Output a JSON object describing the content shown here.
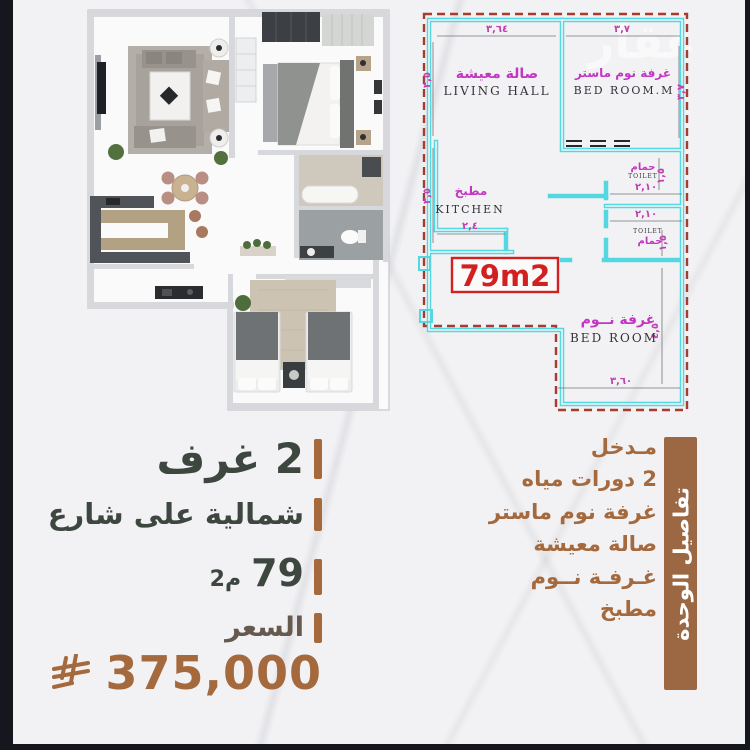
{
  "plan2d": {
    "area_box": "79m2",
    "watermark": "عقار",
    "rooms": {
      "living": {
        "ar": "صالة معيشة",
        "en": "LIVING HALL"
      },
      "master": {
        "ar": "غرفة نوم ماستر",
        "en": "BED ROOM.M"
      },
      "kitchen": {
        "ar": "مطبخ",
        "en": "KITCHEN"
      },
      "toilet1": {
        "ar": "حمام",
        "en": "TOILET"
      },
      "toilet2": {
        "ar": "حمام",
        "en": "TOILET"
      },
      "bedroom": {
        "ar": "غرفة نــوم",
        "en": "BED ROOM"
      }
    },
    "dims": {
      "living_top": "٣,٦٤",
      "master_top": "٣,٧",
      "living_left": "٣,٥",
      "kitchen_left": "٣,٥",
      "master_right": "٣,٧",
      "kitchen_bottom": "٢,٤",
      "toilet1_width": "٢,١٠",
      "toilet2_width": "٢,١٠",
      "toilet1_height": "١,٥",
      "toilet2_height": "١,٥",
      "bedroom_bottom": "٣,٦٠",
      "bedroom_right": "٤,٥"
    }
  },
  "specs": {
    "rooms_count": "2 غرف",
    "orientation": "شمالية على شارع",
    "area_value": "79",
    "area_unit": "م2",
    "price_label": "السعر",
    "price_value": "375,000",
    "currency_icon": "saudi-riyal-symbol"
  },
  "unit_details": {
    "banner": "تفاصيل الوحدة",
    "items": [
      "مـدخل",
      "2 دورات مياه",
      "غرفة نوم ماستر",
      "صالة معيشة",
      "غـرفـة نــوم",
      "مطبخ"
    ]
  },
  "colors": {
    "accent_brown": "#a5693e",
    "banner_brown": "#9c6743",
    "heading_dark": "#3d473f",
    "cad_wall_cyan": "#54d7e0",
    "cad_boundary_red": "#a93a2e",
    "cad_label_magenta": "#c435c4",
    "area_red": "#d21f1f",
    "frame_dark": "#16161e"
  }
}
